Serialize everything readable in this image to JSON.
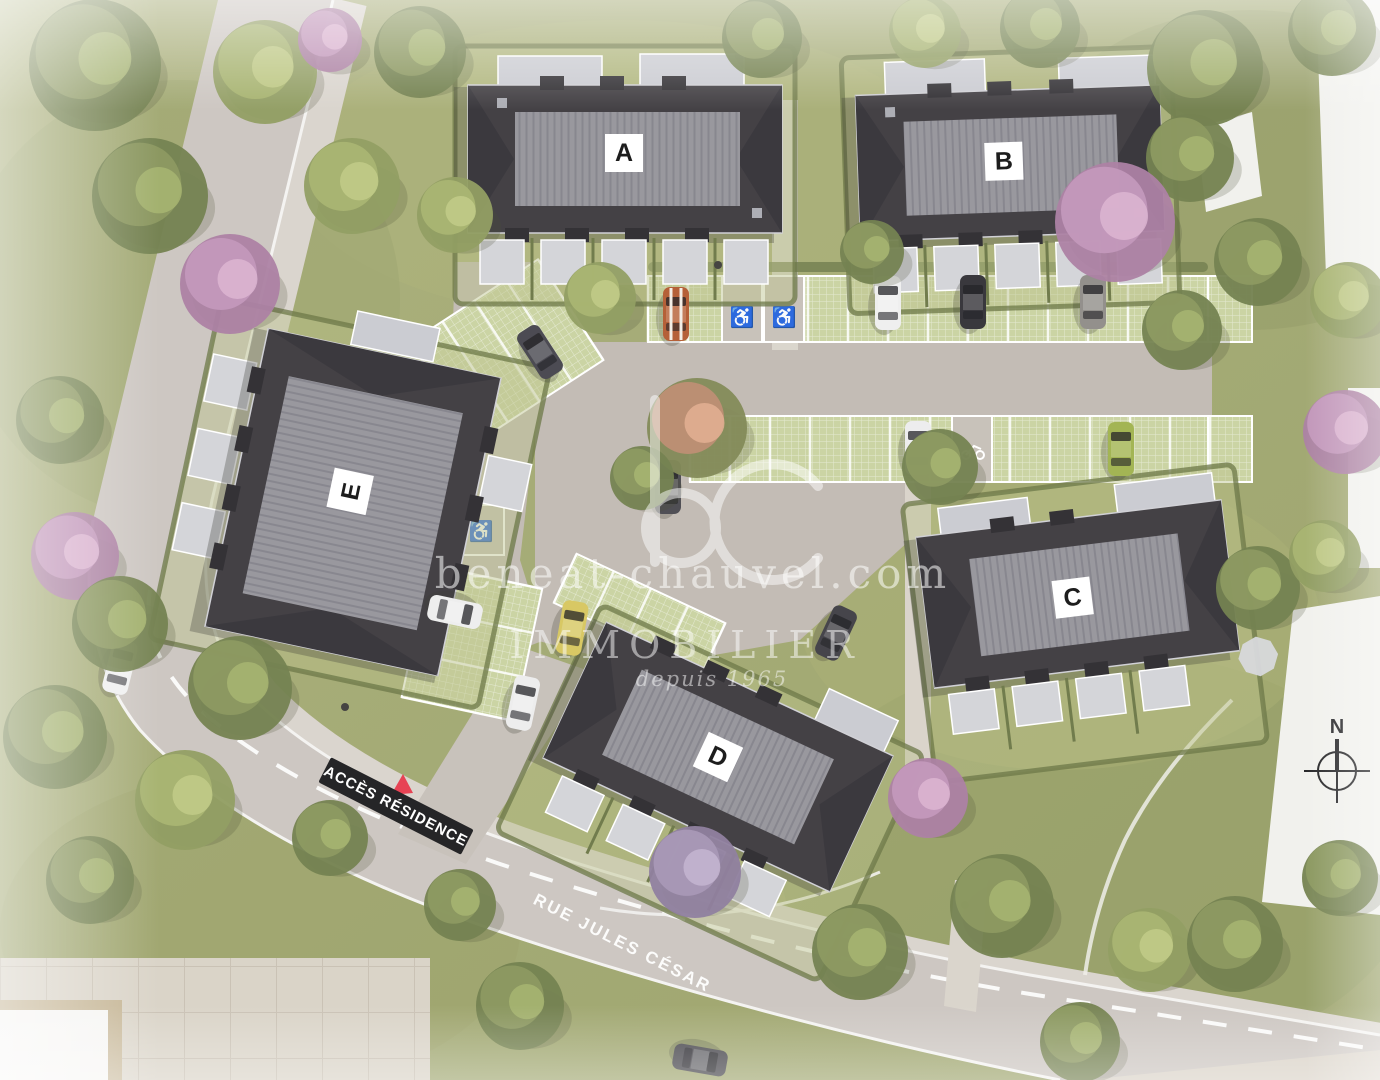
{
  "scene": {
    "type": "aerial residential site plan rendering",
    "buildings": [
      {
        "label": "A"
      },
      {
        "label": "B"
      },
      {
        "label": "C"
      },
      {
        "label": "D"
      },
      {
        "label": "E"
      }
    ],
    "watermark": {
      "logo": "bc",
      "website": "beneat-chauvel.com",
      "brand": "IMMOBILIER",
      "tagline": "depuis 1965"
    },
    "signs": {
      "access": "ACCÈS RÉSIDENCE",
      "street": "RUE JULES CÉSAR"
    },
    "compass": {
      "north": "N"
    },
    "icons": {
      "accessible_parking": "♿"
    },
    "colors": {
      "roof_dark": "#3a373c",
      "roof_ridge": "#94939a",
      "grass": "#a2a873",
      "grass_paver": "#c9d2a0",
      "road": "#cbc5bf",
      "sign_background": "#1a1a1c",
      "sign_text": "#ffffff",
      "access_triangle": "#e6394b",
      "label_plaque": "#ffffff",
      "label_text": "#111111"
    }
  }
}
